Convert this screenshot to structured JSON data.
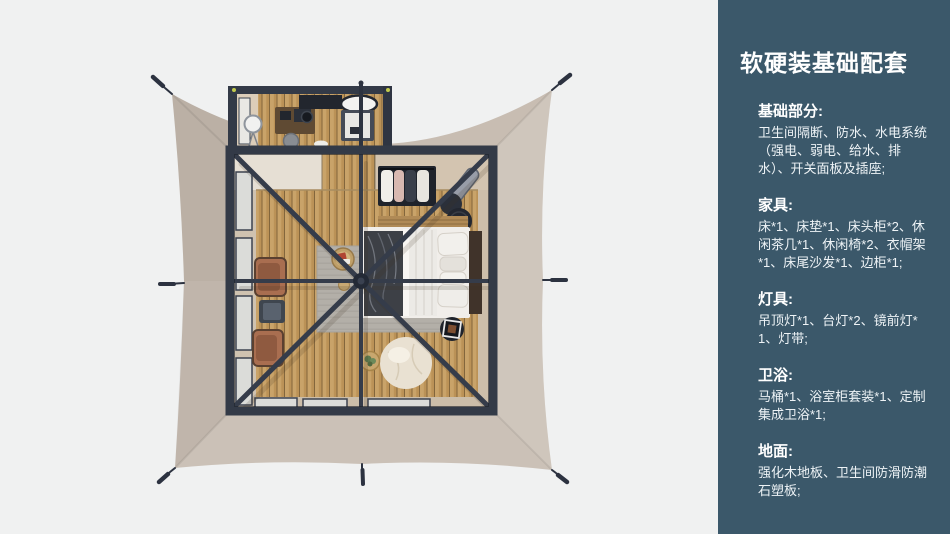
{
  "panel": {
    "title": "软硬装基础配套",
    "sections": [
      {
        "heading": "基础部分:",
        "body": "卫生间隔断、防水、水电系统（强电、弱电、给水、排水）、开关面板及插座;"
      },
      {
        "heading": "家具:",
        "body": "床*1、床垫*1、床头柜*2、休闲茶几*1、休闲椅*2、衣帽架*1、床尾沙发*1、边柜*1;"
      },
      {
        "heading": "灯具:",
        "body": "吊顶灯*1、台灯*2、镜前灯*1、灯带;"
      },
      {
        "heading": "卫浴:",
        "body": "马桶*1、浴室柜套装*1、定制集成卫浴*1;"
      },
      {
        "heading": "地面:",
        "body": "强化木地板、卫生间防滑防潮石塑板;"
      }
    ]
  },
  "palette": {
    "page_background": "#f0f1f1",
    "panel_background": "#3b586a",
    "panel_text": "#ffffff",
    "tent_canvas": "#c8bdb2",
    "frame_beams": "#333a47",
    "wood_floor": "#bb9257",
    "rug": "#b3afa8",
    "chair_leather": "#a96e50",
    "bedding": "#f1eeea",
    "blanket": "#3d4046",
    "bean_bag": "#e9e1d2"
  },
  "floorplan": {
    "view": "top-down tent suite rendering",
    "items": [
      "tent-canvas",
      "guy-lines",
      "roof-beams",
      "bathroom-annex",
      "standing-mirror",
      "vanity",
      "bathtub",
      "shower-unit",
      "bedroom-floor",
      "windows",
      "rug",
      "bed",
      "pillows",
      "headboard",
      "clothes-rack",
      "leaning-mirror",
      "nesting-tables",
      "lounge-chairs",
      "coffee-table",
      "tray-table",
      "side-table",
      "bean-bag",
      "plant-table"
    ]
  }
}
